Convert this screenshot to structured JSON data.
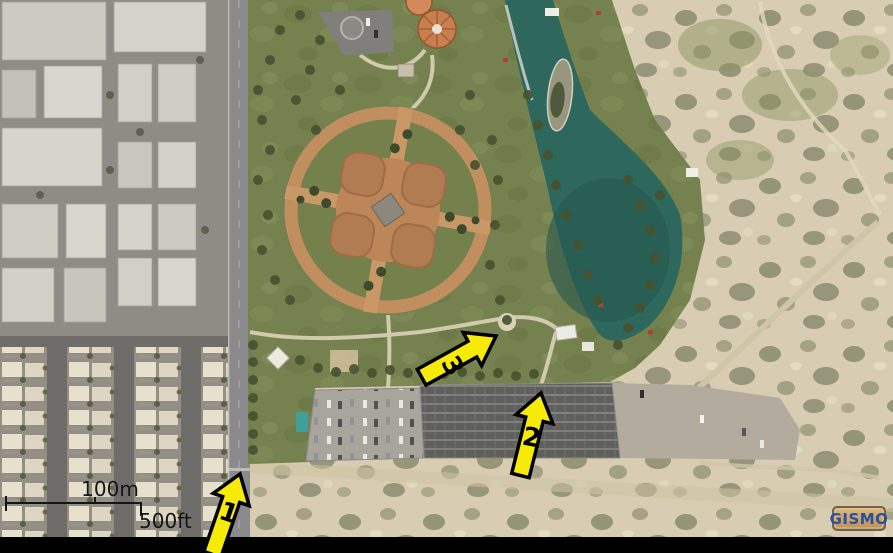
{
  "scale_bar": {
    "metric_label": "100m",
    "imperial_label": "500ft"
  },
  "markers": [
    {
      "label": "1"
    },
    {
      "label": "2"
    },
    {
      "label": "3"
    }
  ],
  "watermark": {
    "label": "GISMO",
    "text_color": "#27509e",
    "background": "#cda268"
  },
  "annotation_colors": {
    "arrow_fill": "#f6ea07",
    "arrow_outline": "#000000",
    "scale_text": "#151515"
  }
}
